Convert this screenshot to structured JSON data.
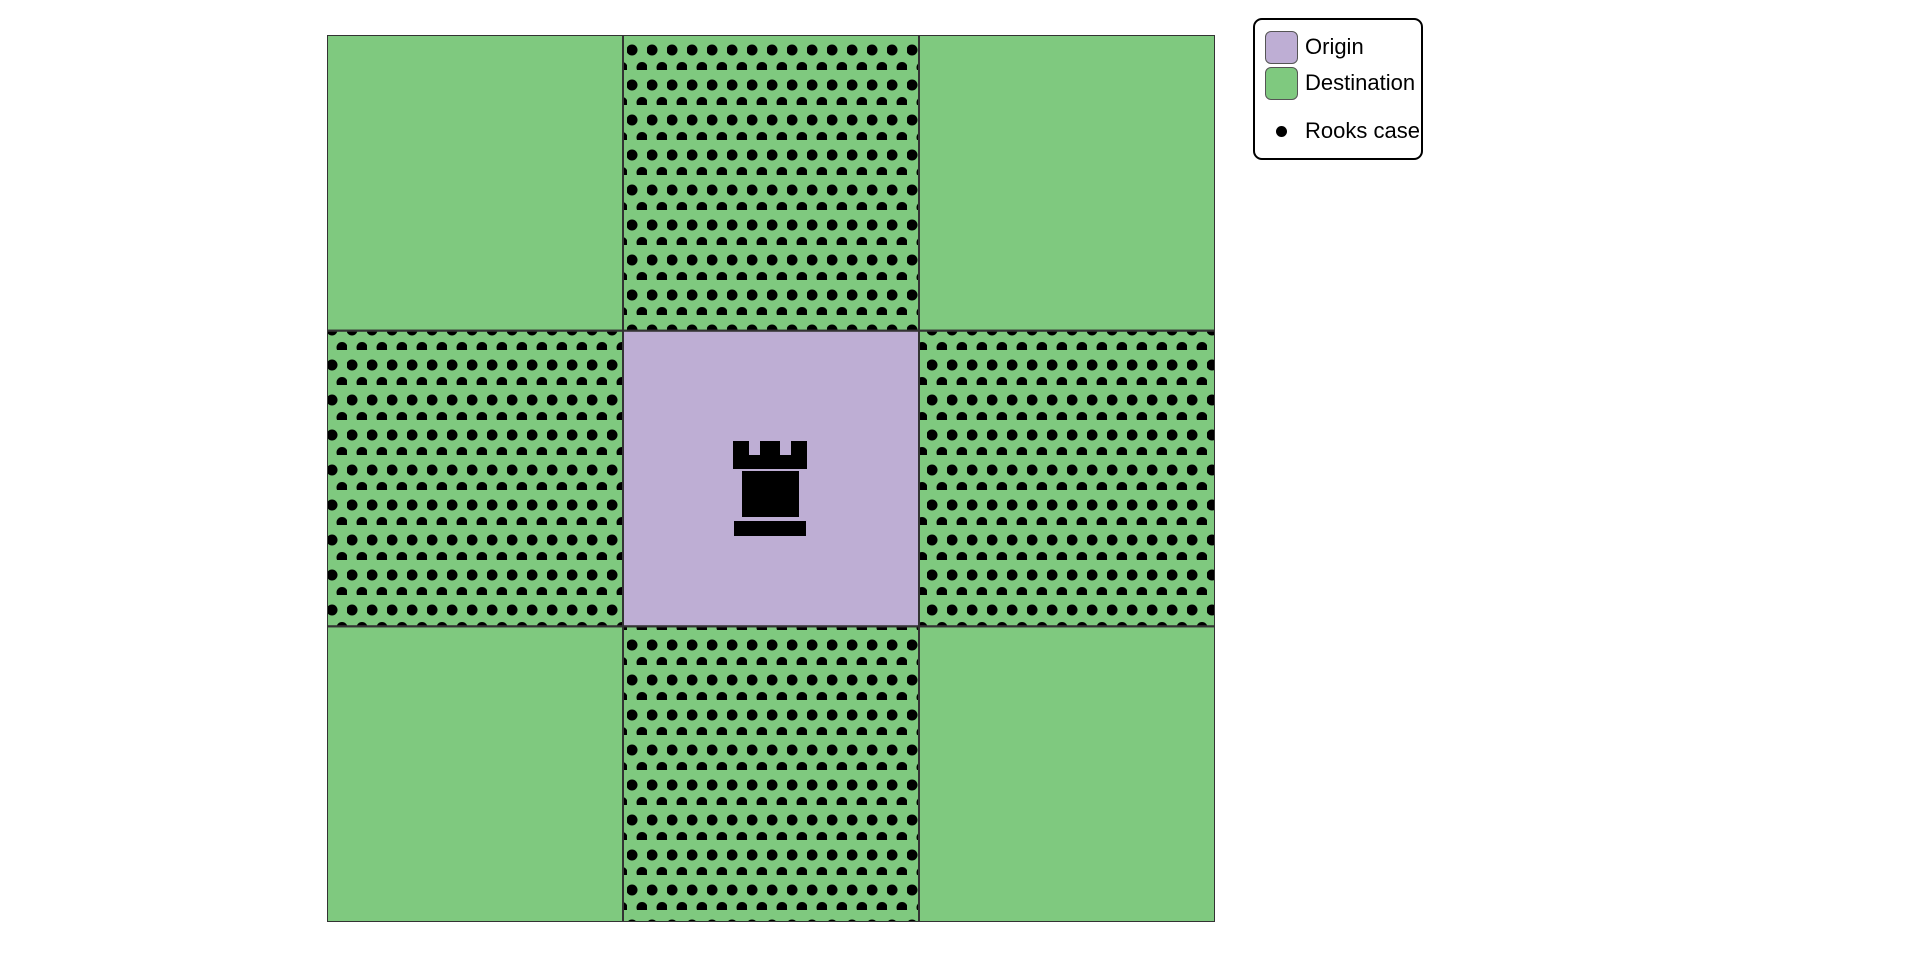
{
  "colors": {
    "background": "#ffffff",
    "origin": "#beaed4",
    "destination": "#7fc97f",
    "dot": "#000000",
    "rook": "#000000",
    "grid_line": "#333333",
    "legend_border": "#000000",
    "legend_swatch_border": "#555555"
  },
  "legend": {
    "items": [
      {
        "label": "Origin",
        "type": "patch",
        "swatch": "origin"
      },
      {
        "label": "Destination",
        "type": "patch",
        "swatch": "destination"
      },
      {
        "label": "Rooks case",
        "type": "dot"
      }
    ]
  },
  "chart_data": {
    "type": "heatmap",
    "title": "",
    "rows": 3,
    "cols": 3,
    "description": "3x3 board: purple origin cell in the center with a black rook marker; all surrounding cells are green destinations; the four orthogonally adjacent cells carry black polka-dot hatching marking the rook's move (Rooks case).",
    "cells": [
      {
        "row": 0,
        "col": 0,
        "role": "destination",
        "rooks_case": false
      },
      {
        "row": 0,
        "col": 1,
        "role": "destination",
        "rooks_case": true
      },
      {
        "row": 0,
        "col": 2,
        "role": "destination",
        "rooks_case": false
      },
      {
        "row": 1,
        "col": 0,
        "role": "destination",
        "rooks_case": true
      },
      {
        "row": 1,
        "col": 1,
        "role": "origin",
        "rooks_case": false,
        "marker": "rook"
      },
      {
        "row": 1,
        "col": 2,
        "role": "destination",
        "rooks_case": true
      },
      {
        "row": 2,
        "col": 0,
        "role": "destination",
        "rooks_case": false
      },
      {
        "row": 2,
        "col": 1,
        "role": "destination",
        "rooks_case": true
      },
      {
        "row": 2,
        "col": 2,
        "role": "destination",
        "rooks_case": false
      }
    ],
    "legend_entries": [
      "Origin",
      "Destination",
      "Rooks case"
    ],
    "legend_position": "upper right",
    "hatch_style": "staggered black dots"
  }
}
